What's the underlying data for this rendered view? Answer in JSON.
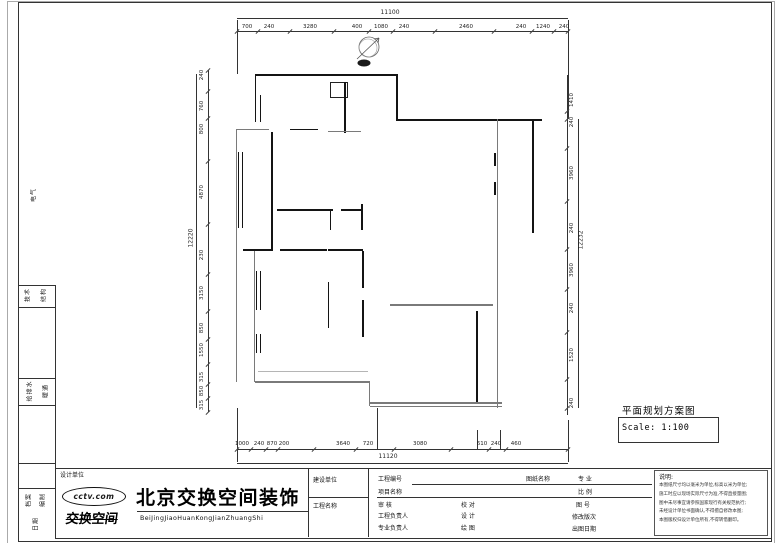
{
  "drawing": {
    "title": "平面规划方案图",
    "scale_label": "Scale: 1:100",
    "overall_top": "11100",
    "overall_bottom": "11120",
    "overall_left": "12220",
    "overall_right": "12232"
  },
  "dims": {
    "top": [
      [
        "700",
        247
      ],
      [
        "240",
        269
      ],
      [
        "3280",
        310
      ],
      [
        "400",
        357
      ],
      [
        "1080",
        381
      ],
      [
        "240",
        404
      ],
      [
        "2460",
        466
      ],
      [
        "240",
        521
      ],
      [
        "1240",
        543
      ],
      [
        "240",
        564
      ]
    ],
    "bottom": [
      [
        "1000",
        242
      ],
      [
        "240",
        259
      ],
      [
        "870",
        272
      ],
      [
        "200",
        284
      ],
      [
        "3640",
        343
      ],
      [
        "720",
        368
      ],
      [
        "3080",
        420
      ],
      [
        "610",
        482
      ],
      [
        "240",
        496
      ],
      [
        "460",
        516
      ]
    ],
    "left": [
      [
        "240",
        75
      ],
      [
        "760",
        106
      ],
      [
        "800",
        129
      ],
      [
        "4870",
        192
      ],
      [
        "230",
        255
      ],
      [
        "3150",
        293
      ],
      [
        "850",
        328
      ],
      [
        "1550",
        350
      ],
      [
        "315",
        377
      ],
      [
        "850",
        391
      ],
      [
        "315",
        405
      ]
    ],
    "right": [
      [
        "1410",
        100
      ],
      [
        "240",
        122
      ],
      [
        "3960",
        173
      ],
      [
        "240",
        228
      ],
      [
        "3960",
        270
      ],
      [
        "240",
        308
      ],
      [
        "1520",
        355
      ],
      [
        "240",
        403
      ]
    ]
  },
  "plan": {
    "walls": [
      [
        255,
        74,
        143,
        1.8,
        "k"
      ],
      [
        396,
        74,
        1.8,
        47,
        "k"
      ],
      [
        396,
        119,
        146,
        1.8,
        "k"
      ],
      [
        532,
        121,
        2.2,
        112,
        "k"
      ],
      [
        497,
        119,
        1,
        289,
        "g"
      ],
      [
        344,
        82,
        2,
        51,
        "k"
      ],
      [
        255,
        74,
        1.2,
        23,
        "k"
      ],
      [
        255,
        95,
        1,
        27,
        "k"
      ],
      [
        259.5,
        95,
        1,
        27,
        "k"
      ],
      [
        237,
        129,
        32,
        1.4,
        "g"
      ],
      [
        290,
        128.5,
        28,
        1.8,
        "k"
      ],
      [
        328,
        130.5,
        33,
        1.4,
        "g"
      ],
      [
        236,
        129,
        1.4,
        253,
        "g"
      ],
      [
        238,
        152,
        1,
        76,
        "k"
      ],
      [
        241.5,
        152,
        1,
        76,
        "k"
      ],
      [
        271,
        132,
        2,
        118,
        "k"
      ],
      [
        277,
        209,
        56,
        1.6,
        "k"
      ],
      [
        341,
        209,
        21,
        1.6,
        "k"
      ],
      [
        330,
        210,
        1.4,
        20,
        "k"
      ],
      [
        361,
        204,
        2,
        26,
        "k"
      ],
      [
        243,
        249,
        30,
        1.6,
        "k"
      ],
      [
        280,
        249,
        47,
        1.6,
        "k"
      ],
      [
        328,
        249,
        35,
        1.6,
        "k"
      ],
      [
        362,
        251,
        2,
        37,
        "k"
      ],
      [
        362,
        300,
        2,
        37,
        "k"
      ],
      [
        328,
        282,
        1.4,
        46,
        "k"
      ],
      [
        256,
        271,
        1,
        39,
        "k"
      ],
      [
        259.5,
        271,
        1,
        39,
        "k"
      ],
      [
        256,
        334,
        1,
        19,
        "k"
      ],
      [
        259.5,
        334,
        1,
        19,
        "k"
      ],
      [
        254,
        251,
        1.2,
        131,
        "g"
      ],
      [
        255,
        381,
        115,
        1.6,
        "g"
      ],
      [
        258,
        371,
        110,
        1,
        "l"
      ],
      [
        390,
        304,
        103,
        1.6,
        "g"
      ],
      [
        476,
        311,
        2,
        92,
        "k"
      ],
      [
        370,
        402,
        132,
        1.8,
        "g"
      ],
      [
        370,
        405.5,
        132,
        1,
        "g"
      ],
      [
        369,
        381,
        1.2,
        25,
        "g"
      ],
      [
        494,
        153,
        2,
        13,
        "k"
      ],
      [
        494,
        182,
        2,
        13,
        "k"
      ]
    ]
  },
  "margin": {
    "labels": [
      [
        "电气",
        33,
        195
      ],
      [
        "技术",
        27,
        295
      ],
      [
        "结构",
        43,
        295
      ],
      [
        "给排水",
        29,
        391
      ],
      [
        "暖通",
        45,
        391
      ],
      [
        "档案",
        28,
        500
      ],
      [
        "编制",
        42,
        500
      ],
      [
        "日期",
        35,
        524
      ]
    ]
  },
  "titleblock": {
    "design_unit_label": "设计单位",
    "logo_top": "cctv.com",
    "logo_bottom": "交换空间",
    "company_name": "北京交换空间装饰",
    "company_pinyin": "BeiJingJiaoHuanKongJianZhuangShi",
    "client_label": "建设单位",
    "project_name_label": "工程名称",
    "project_no_label": "工程编号",
    "item_name_label": "项目名称",
    "review_label": "审 核",
    "project_lead_label": "工程负责人",
    "discipline_lead_label": "专业负责人",
    "check_label": "校 对",
    "design_label": "设 计",
    "draft_label": "绘 图",
    "sheet_name_label": "图纸名称",
    "major_label": "专 业",
    "scale_row_label": "比 例",
    "sheet_no_label": "图 号",
    "revision_label": "修改版次",
    "issue_date_label": "出图日期",
    "notes_heading": "说明:",
    "notes_lines": [
      "本图纸尺寸均以毫米为单位,标高以米为单位;",
      "施工时应以现场实际尺寸为准,不得直接量图;",
      "图中未尽事宜请参照国家现行有关规范执行;",
      "未经设计单位书面确认,不得擅自修改本图;",
      "本图版权归设计单位所有,不得转借翻印。"
    ]
  }
}
